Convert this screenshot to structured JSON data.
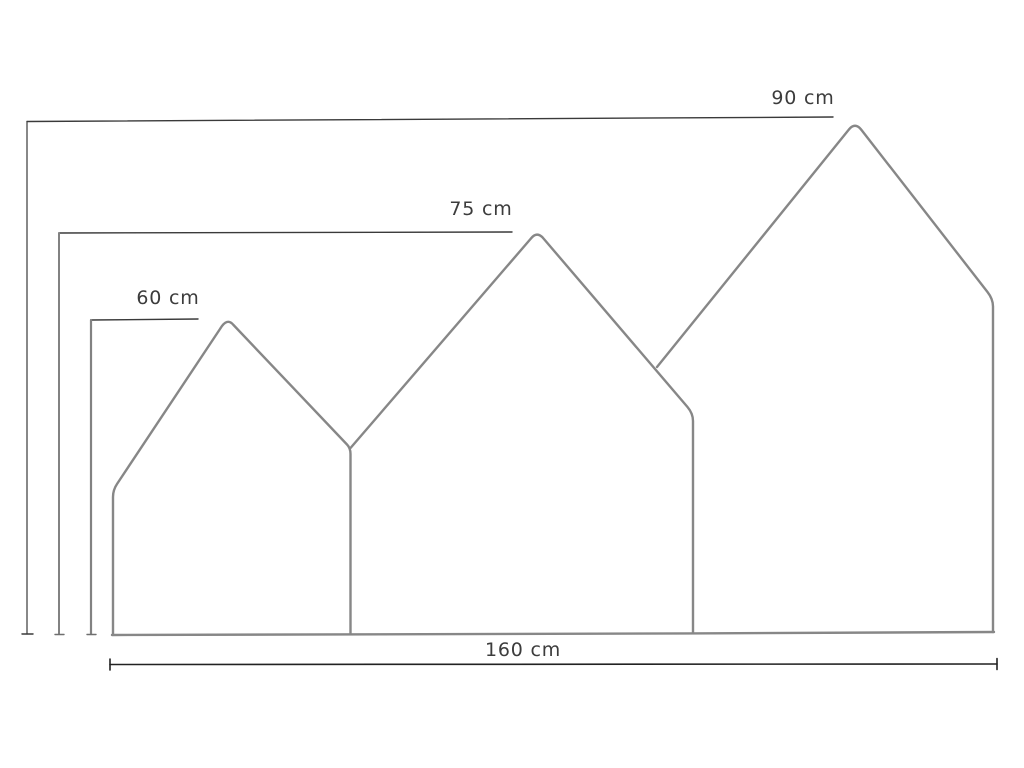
{
  "figure": {
    "title": "house-shaped panel dimension drawing",
    "unit": "cm",
    "colors": {
      "background": "#ffffff",
      "outline": "#878787",
      "dimension_line": "#3a3a3a",
      "width_line": "#222222",
      "text": "#3c3c3c"
    },
    "dimensions": [
      {
        "id": "height-small",
        "label": "60 cm",
        "value": 60,
        "kind": "height",
        "applies_to": "small-house-peak"
      },
      {
        "id": "height-medium",
        "label": "75 cm",
        "value": 75,
        "kind": "height",
        "applies_to": "medium-house-peak"
      },
      {
        "id": "height-large",
        "label": "90 cm",
        "value": 90,
        "kind": "height",
        "applies_to": "large-house-peak"
      },
      {
        "id": "width-total",
        "label": "160 cm",
        "value": 160,
        "kind": "width",
        "applies_to": "overall-base"
      }
    ]
  }
}
